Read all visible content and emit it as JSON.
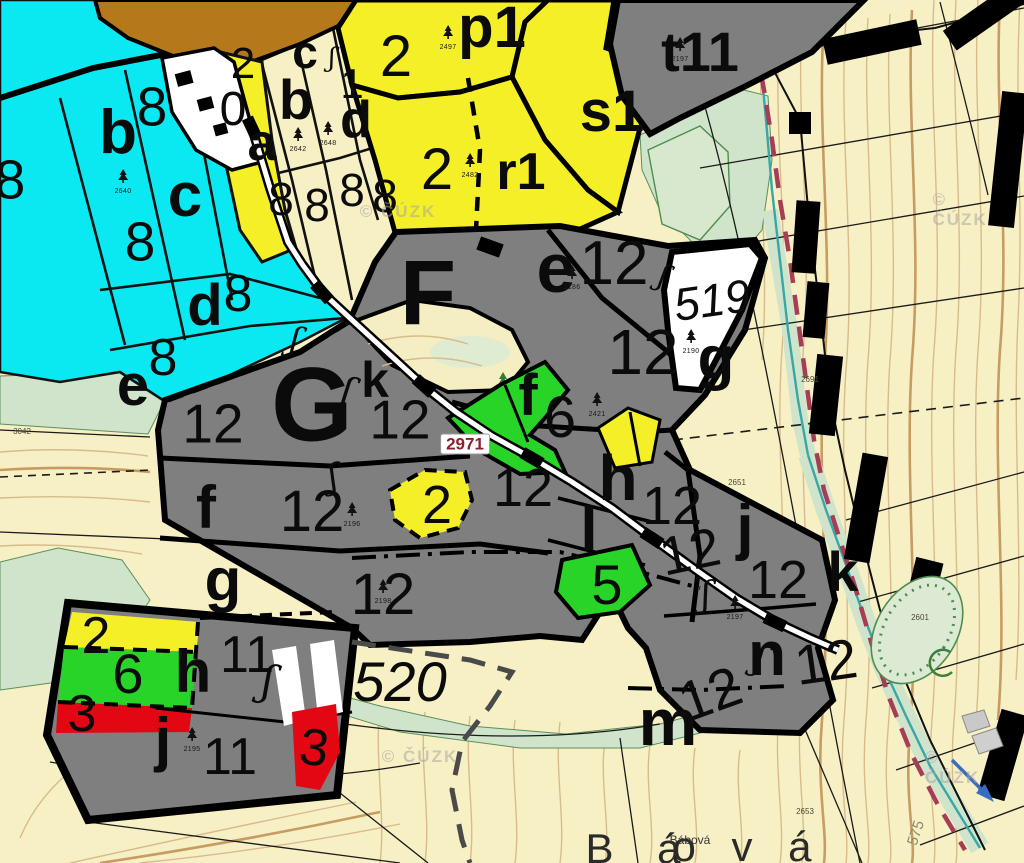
{
  "map": {
    "type": "forest-stand-cadastral-map",
    "colors": {
      "water_cyan": "#0ae9f2",
      "stand_yellow": "#f4ef27",
      "forest_gray": "#7f7f7f",
      "meadow_green": "#28d428",
      "clearing_red": "#e30613",
      "parcel_white": "#ffffff",
      "background_cream": "#f7f0c4",
      "shrub_green": "#cfe4cb",
      "urban_brown": "#b5791b",
      "contour_tan": "#d8bb8c",
      "boundary_red": "#a63d55",
      "stream_teal": "#3aa7a7",
      "road_label_red": "#8e1f2f"
    },
    "labels": [
      {
        "t": "8",
        "x": 10,
        "y": 180,
        "s": 55
      },
      {
        "t": "b",
        "x": 118,
        "y": 133,
        "s": 62,
        "b": 1
      },
      {
        "t": "8",
        "x": 152,
        "y": 107,
        "s": 55
      },
      {
        "t": "c",
        "x": 185,
        "y": 196,
        "s": 62,
        "b": 1
      },
      {
        "t": "8",
        "x": 140,
        "y": 242,
        "s": 55
      },
      {
        "t": "d",
        "x": 205,
        "y": 306,
        "s": 58,
        "b": 1
      },
      {
        "t": "8",
        "x": 238,
        "y": 294,
        "s": 52
      },
      {
        "t": "e",
        "x": 133,
        "y": 386,
        "s": 58,
        "b": 1
      },
      {
        "t": "8",
        "x": 163,
        "y": 358,
        "s": 52
      },
      {
        "t": "2",
        "x": 243,
        "y": 64,
        "s": 44
      },
      {
        "t": "0",
        "x": 233,
        "y": 110,
        "s": 48
      },
      {
        "t": "a",
        "x": 262,
        "y": 143,
        "s": 52,
        "b": 1
      },
      {
        "t": "c",
        "x": 305,
        "y": 52,
        "s": 46,
        "b": 1
      },
      {
        "t": "b",
        "x": 296,
        "y": 100,
        "s": 56,
        "b": 1
      },
      {
        "t": "1",
        "x": 352,
        "y": 84,
        "s": 42
      },
      {
        "t": "d",
        "x": 356,
        "y": 120,
        "s": 52,
        "b": 1
      },
      {
        "t": "8",
        "x": 281,
        "y": 199,
        "s": 46
      },
      {
        "t": "8",
        "x": 317,
        "y": 205,
        "s": 46
      },
      {
        "t": "8",
        "x": 352,
        "y": 190,
        "s": 46
      },
      {
        "t": "8",
        "x": 385,
        "y": 196,
        "s": 46
      },
      {
        "t": "2",
        "x": 396,
        "y": 57,
        "s": 58
      },
      {
        "t": "p1",
        "x": 492,
        "y": 28,
        "s": 58,
        "b": 1
      },
      {
        "t": "s1",
        "x": 612,
        "y": 112,
        "s": 58,
        "b": 1
      },
      {
        "t": "2",
        "x": 437,
        "y": 170,
        "s": 58
      },
      {
        "t": "r1",
        "x": 521,
        "y": 172,
        "s": 52,
        "b": 1
      },
      {
        "t": "t11",
        "x": 700,
        "y": 52,
        "s": 56,
        "b": 1
      },
      {
        "t": "F",
        "x": 428,
        "y": 293,
        "s": 92,
        "b": 1
      },
      {
        "t": "e",
        "x": 556,
        "y": 268,
        "s": 70,
        "b": 1
      },
      {
        "t": "12",
        "x": 614,
        "y": 264,
        "s": 62
      },
      {
        "t": "12",
        "x": 643,
        "y": 352,
        "s": 64
      },
      {
        "t": "519",
        "x": 712,
        "y": 300,
        "s": 46,
        "i": 1,
        "r": -8,
        "n": "cadastre-number"
      },
      {
        "t": "g",
        "x": 716,
        "y": 358,
        "s": 60,
        "b": 1
      },
      {
        "t": "G",
        "x": 312,
        "y": 405,
        "s": 105,
        "b": 1
      },
      {
        "t": "k",
        "x": 375,
        "y": 380,
        "s": 50,
        "b": 1
      },
      {
        "t": "12",
        "x": 400,
        "y": 420,
        "s": 55
      },
      {
        "t": "f",
        "x": 528,
        "y": 396,
        "s": 58,
        "b": 1
      },
      {
        "t": "6",
        "x": 560,
        "y": 418,
        "s": 58
      },
      {
        "t": "12",
        "x": 523,
        "y": 488,
        "s": 54
      },
      {
        "t": "h",
        "x": 618,
        "y": 478,
        "s": 64,
        "b": 1
      },
      {
        "t": "12",
        "x": 672,
        "y": 506,
        "s": 54
      },
      {
        "t": "12",
        "x": 690,
        "y": 552,
        "s": 54,
        "r": -12
      },
      {
        "t": "l",
        "x": 589,
        "y": 530,
        "s": 62,
        "b": 1
      },
      {
        "t": "5",
        "x": 607,
        "y": 585,
        "s": 56
      },
      {
        "t": "2",
        "x": 437,
        "y": 505,
        "s": 54
      },
      {
        "t": "f",
        "x": 206,
        "y": 508,
        "s": 60,
        "b": 1
      },
      {
        "t": "12",
        "x": 312,
        "y": 512,
        "s": 58
      },
      {
        "t": "g",
        "x": 223,
        "y": 580,
        "s": 60,
        "b": 1
      },
      {
        "t": "12",
        "x": 383,
        "y": 595,
        "s": 58
      },
      {
        "t": "12",
        "x": 213,
        "y": 424,
        "s": 55
      },
      {
        "t": "j",
        "x": 745,
        "y": 528,
        "s": 62,
        "b": 1
      },
      {
        "t": "12",
        "x": 778,
        "y": 580,
        "s": 54
      },
      {
        "t": "k",
        "x": 843,
        "y": 572,
        "s": 56,
        "b": 1
      },
      {
        "t": "n",
        "x": 767,
        "y": 655,
        "s": 62,
        "b": 1
      },
      {
        "t": "12",
        "x": 826,
        "y": 662,
        "s": 56,
        "r": -8
      },
      {
        "t": "12",
        "x": 710,
        "y": 694,
        "s": 56,
        "r": -20
      },
      {
        "t": "m",
        "x": 668,
        "y": 722,
        "s": 66,
        "b": 1
      },
      {
        "t": "2",
        "x": 96,
        "y": 636,
        "s": 52
      },
      {
        "t": "6",
        "x": 128,
        "y": 674,
        "s": 56
      },
      {
        "t": "3",
        "x": 82,
        "y": 714,
        "s": 52
      },
      {
        "t": "h",
        "x": 193,
        "y": 672,
        "s": 60,
        "b": 1
      },
      {
        "t": "11",
        "x": 247,
        "y": 655,
        "s": 52
      },
      {
        "t": "j",
        "x": 163,
        "y": 740,
        "s": 60,
        "b": 1
      },
      {
        "t": "11",
        "x": 230,
        "y": 757,
        "s": 52
      },
      {
        "t": "3",
        "x": 314,
        "y": 748,
        "s": 52,
        "r": 8
      },
      {
        "t": "520",
        "x": 400,
        "y": 682,
        "s": 56,
        "i": 1,
        "n": "cadastre-number"
      },
      {
        "t": "2971",
        "x": 465,
        "y": 444,
        "s": 17,
        "b": 1,
        "c": "#8e1f2f",
        "bg": "#ffffff",
        "n": "road-number-label"
      },
      {
        "t": "B á",
        "x": 641,
        "y": 849,
        "s": 42,
        "ls": 16,
        "c": "#2a2a2a",
        "n": "place-name"
      },
      {
        "t": "o v á",
        "x": 748,
        "y": 847,
        "s": 42,
        "ls": 12,
        "c": "#2a2a2a",
        "n": "place-name"
      },
      {
        "t": "Bábová",
        "x": 690,
        "y": 840,
        "s": 12,
        "c": "#333333",
        "n": "place-name-small"
      },
      {
        "t": "575",
        "x": 916,
        "y": 833,
        "s": 15,
        "r": -72,
        "c": "#8a8a70",
        "n": "road-name-rotated"
      },
      {
        "t": "ʃ",
        "x": 347,
        "y": 391,
        "s": 38,
        "r": 15,
        "q": 1,
        "n": "squiggle-symbol"
      },
      {
        "t": "ʃ",
        "x": 333,
        "y": 477,
        "s": 34,
        "r": -10,
        "q": 1,
        "n": "squiggle-symbol"
      },
      {
        "t": "ʃ",
        "x": 295,
        "y": 340,
        "s": 34,
        "r": 12,
        "q": 1,
        "n": "squiggle-symbol"
      },
      {
        "t": "ʃ",
        "x": 268,
        "y": 681,
        "s": 42,
        "r": 8,
        "q": 1,
        "n": "squiggle-symbol"
      },
      {
        "t": "ʃ",
        "x": 663,
        "y": 277,
        "s": 30,
        "r": 18,
        "q": 1,
        "n": "squiggle-symbol"
      },
      {
        "t": "ʃ",
        "x": 706,
        "y": 596,
        "s": 36,
        "r": 0,
        "q": 1,
        "n": "squiggle-symbol"
      },
      {
        "t": "ʃ",
        "x": 760,
        "y": 659,
        "s": 36,
        "r": 14,
        "q": 1,
        "n": "squiggle-symbol"
      },
      {
        "t": "ʃ",
        "x": 332,
        "y": 58,
        "s": 26,
        "r": 0,
        "q": 1,
        "n": "squiggle-symbol"
      }
    ],
    "stand_marks": [
      {
        "x": 123,
        "y": 182,
        "num": "2640"
      },
      {
        "x": 298,
        "y": 140,
        "num": "2642"
      },
      {
        "x": 328,
        "y": 134,
        "num": "2648"
      },
      {
        "x": 448,
        "y": 38,
        "num": "2497"
      },
      {
        "x": 470,
        "y": 166,
        "num": "2482"
      },
      {
        "x": 680,
        "y": 50,
        "num": "2197"
      },
      {
        "x": 572,
        "y": 278,
        "num": "2186"
      },
      {
        "x": 691,
        "y": 342,
        "num": "2190"
      },
      {
        "x": 597,
        "y": 405,
        "num": "2421"
      },
      {
        "x": 352,
        "y": 515,
        "num": "2196"
      },
      {
        "x": 383,
        "y": 592,
        "num": "2198"
      },
      {
        "x": 735,
        "y": 608,
        "num": "2197"
      },
      {
        "x": 192,
        "y": 740,
        "num": "2195"
      }
    ],
    "tiny_numbers": [
      {
        "x": 22,
        "y": 432,
        "t": "3042"
      },
      {
        "x": 737,
        "y": 483,
        "t": "2651"
      },
      {
        "x": 810,
        "y": 380,
        "t": "2691"
      },
      {
        "x": 920,
        "y": 618,
        "t": "2601"
      },
      {
        "x": 805,
        "y": 812,
        "t": "2653"
      }
    ],
    "watermarks": [
      {
        "x": 398,
        "y": 212,
        "t": "© ČÚZK"
      },
      {
        "x": 963,
        "y": 210,
        "t": "© ČÚZK"
      },
      {
        "x": 420,
        "y": 757,
        "t": "© ČÚZK"
      },
      {
        "x": 958,
        "y": 768,
        "t": "© ČÚZK"
      }
    ]
  }
}
